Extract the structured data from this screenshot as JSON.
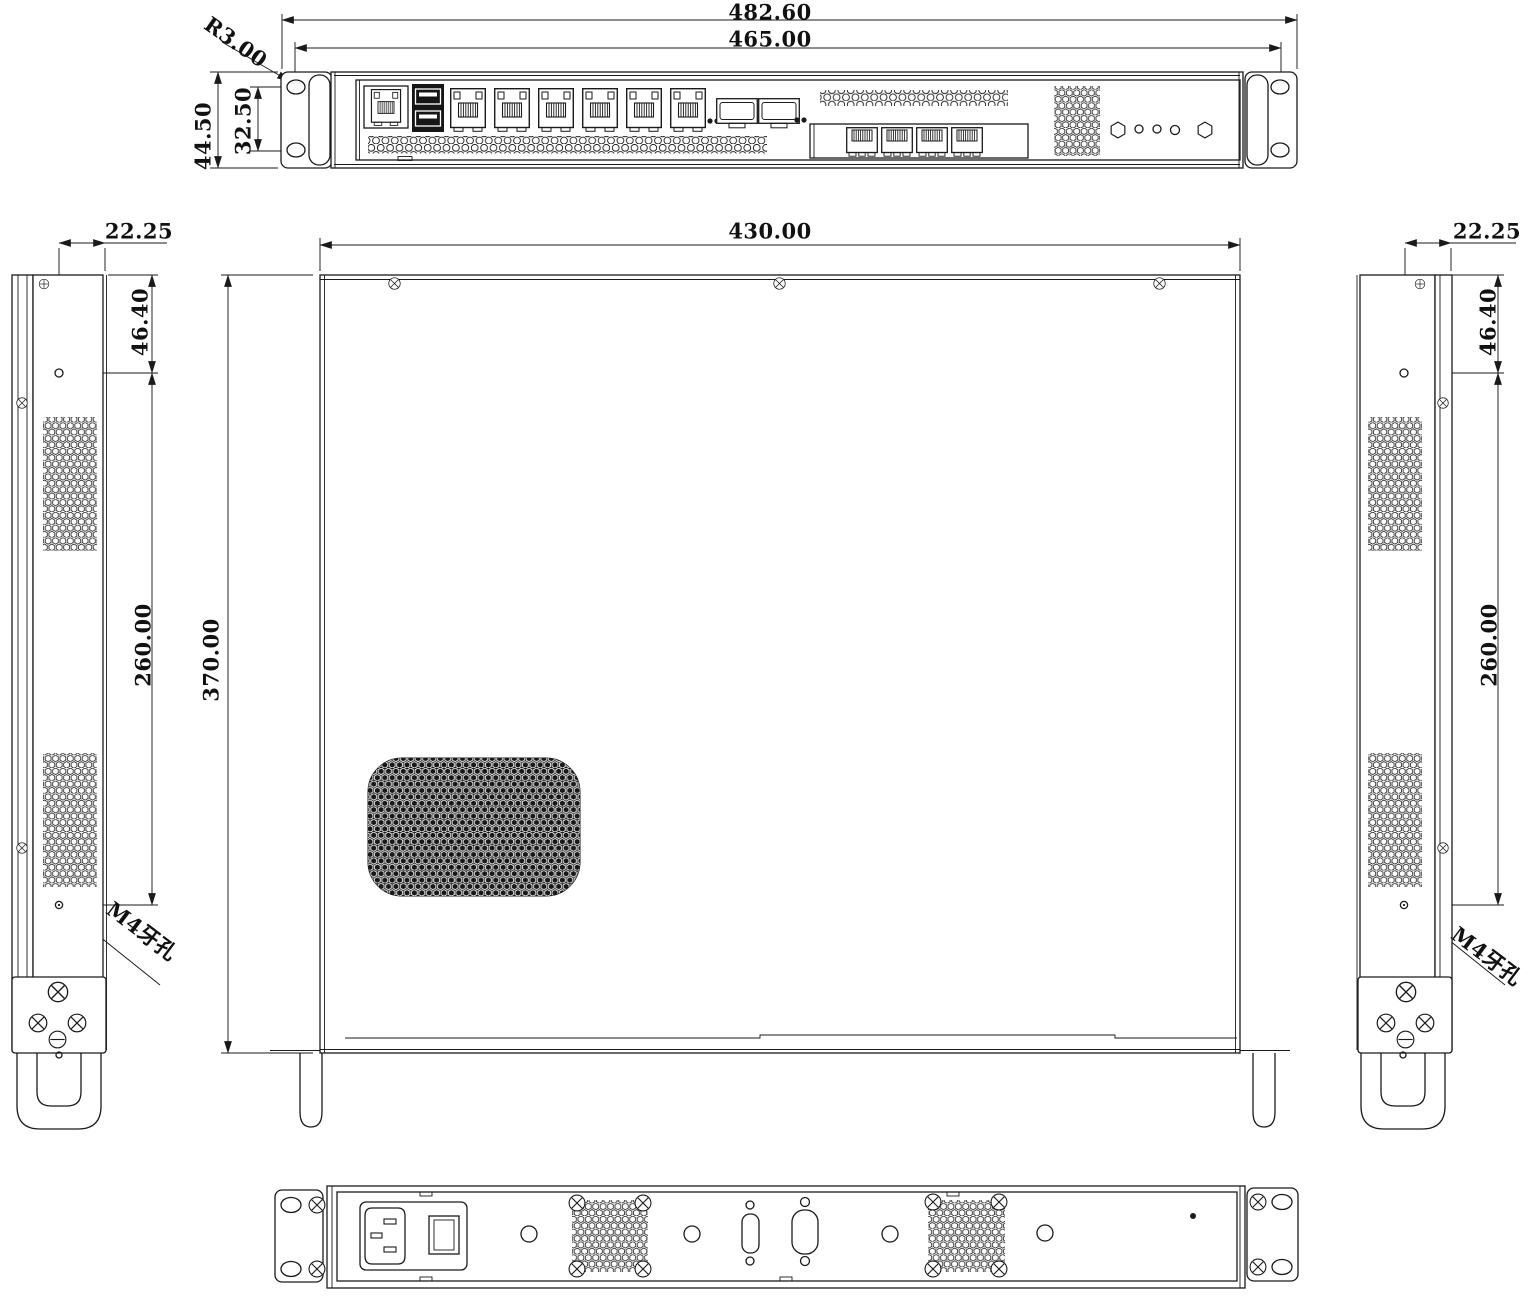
{
  "dimensions": {
    "front": {
      "overall_width": "482.60",
      "mounting_width": "465.00",
      "corner_radius": "R3.00",
      "height": "44.50",
      "slot_spacing": "32.50"
    },
    "top": {
      "width": "430.00",
      "depth": "370.00"
    },
    "left_side": {
      "hole_offset": "22.25",
      "hole_front_distance": "46.40",
      "hole_pitch": "260.00",
      "thread_label": "M4牙孔"
    },
    "right_side": {
      "hole_offset": "22.25",
      "hole_front_distance": "46.40",
      "hole_pitch": "260.00",
      "thread_label": "M4牙孔"
    }
  },
  "colors": {
    "line": "#1a1a1a",
    "background": "#ffffff"
  }
}
